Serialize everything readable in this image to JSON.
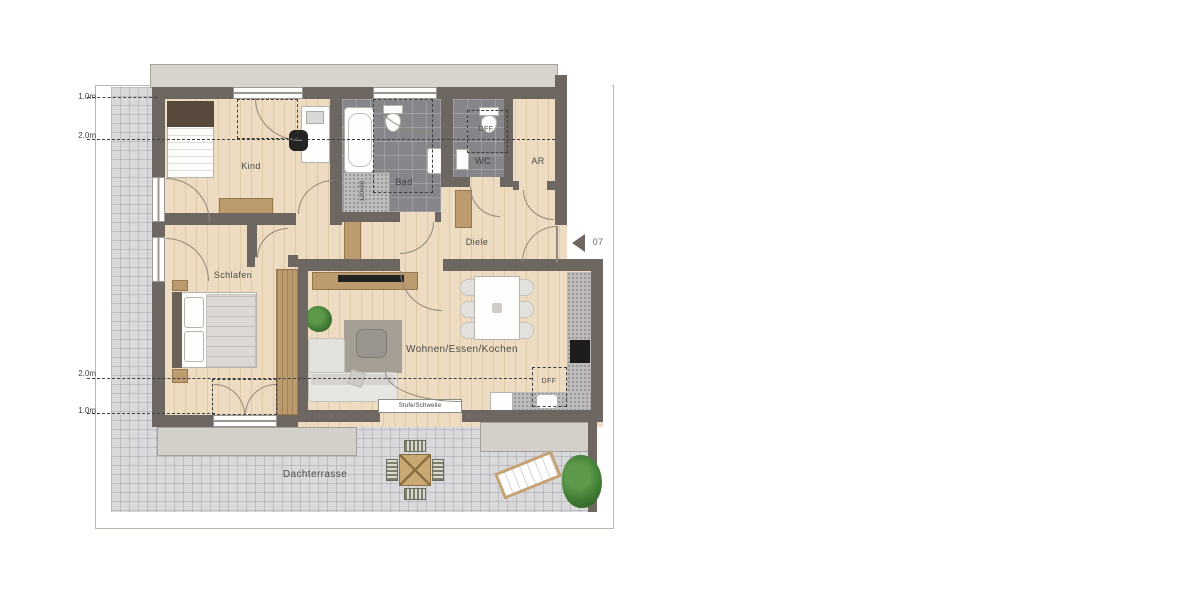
{
  "plan": {
    "rooms": [
      {
        "id": "kind",
        "label": "Kind"
      },
      {
        "id": "bad",
        "label": "Bad"
      },
      {
        "id": "wc",
        "label": "WC"
      },
      {
        "id": "ar",
        "label": "AR"
      },
      {
        "id": "diele",
        "label": "Diele"
      },
      {
        "id": "schlafen",
        "label": "Schlafen"
      },
      {
        "id": "wohnen",
        "label": "Wohnen/Essen/Kochen"
      },
      {
        "id": "dachterrasse",
        "label": "Dachterrasse"
      }
    ],
    "dimension_marks": {
      "top_first": "1.0m",
      "top_second": "2.0m",
      "bottom_first": "2.0m",
      "bottom_second": "1.0m"
    },
    "annotations": {
      "roof_window_wc": "DFF",
      "roof_window_kitchen": "DFF",
      "threshold": "Stufe/Schwelle",
      "shower_size": "120x90",
      "unit_number": "07"
    },
    "colors": {
      "wall": "#6e6761",
      "wood_floor": "#eddcc1",
      "bath_tile": "#85858a",
      "terrace_tile": "#d9d9dc",
      "furniture_wood": "#bb9a6e",
      "plant_green": "#3f7a33",
      "dash_line": "#3f3f3f"
    }
  }
}
